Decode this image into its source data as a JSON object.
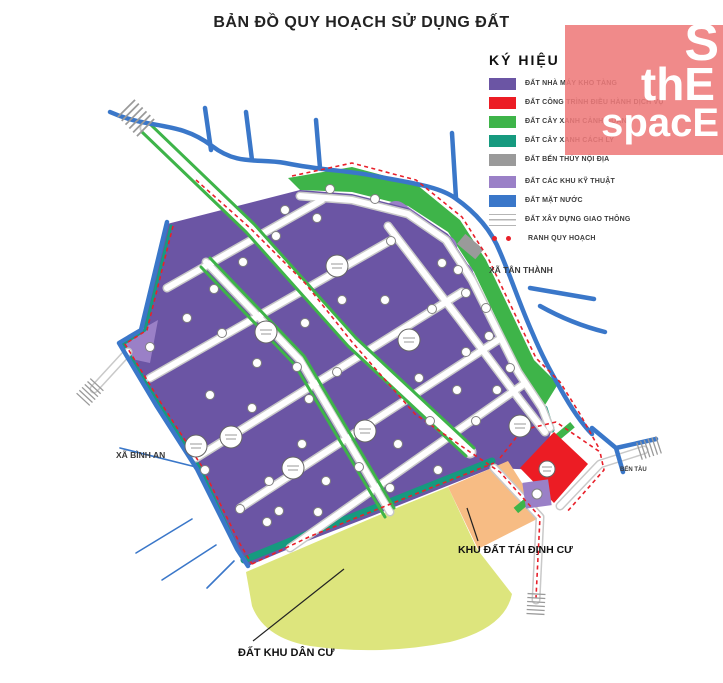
{
  "title": "BẢN ĐỒ QUY HOẠCH SỬ DỤNG ĐẤT",
  "watermark": {
    "word1": "S",
    "word2": "thE",
    "word3": "spacE",
    "bg_color": "#ee7a7a"
  },
  "legend": {
    "title": "KÝ HIỆU",
    "items": [
      {
        "label": "ĐẤT NHÀ MÁY KHO TÀNG",
        "color": "#6b55a4",
        "type": "swatch"
      },
      {
        "label": "ĐẤT CÔNG TRÌNH ĐIỀU HÀNH DỊCH VỤ",
        "color": "#ec1c24",
        "type": "swatch"
      },
      {
        "label": "ĐẤT CÂY XANH CẢNH QUAN",
        "color": "#3eb449",
        "type": "swatch"
      },
      {
        "label": "ĐẤT CÂY XANH CÁCH LY",
        "color": "#169a7f",
        "type": "swatch"
      },
      {
        "label": "ĐẤT BẾN THỦY NỘI ĐỊA",
        "color": "#9a9a9a",
        "type": "swatch"
      },
      {
        "label": "ĐẤT CÁC KHU KỸ THUẬT",
        "color": "#9a80c7",
        "type": "swatch"
      },
      {
        "label": "ĐẤT MẶT NƯỚC",
        "color": "#3a77c9",
        "type": "swatch"
      },
      {
        "label": "ĐẤT XÂY DỰNG GIAO THÔNG",
        "color": "#ffffff",
        "type": "road"
      },
      {
        "label": "RANH QUY HOẠCH",
        "color": "#e8202a",
        "type": "dots"
      }
    ]
  },
  "map_labels": {
    "xa_tan_thanh": "XÃ TÂN THÀNH",
    "xa_binh_an": "XÃ BÌNH AN",
    "ben_tau": "BẾN TÀU",
    "khu_dat_tai_dinh_cu": "KHU ĐẤT TÁI ĐỊNH CƯ",
    "dat_khu_dan_cu": "ĐẤT KHU DÂN CƯ"
  },
  "colors": {
    "factory_purple": "#6b55a4",
    "service_red": "#ec1c24",
    "landscape_green": "#3eb449",
    "isolation_teal": "#169a7f",
    "dock_gray": "#9a9a9a",
    "technical_purple": "#9a80c7",
    "water_blue": "#3a77c9",
    "residential_yellow": "#dde57d",
    "resettlement_orange": "#f7bc84",
    "boundary_dash_red": "#e8202a"
  }
}
